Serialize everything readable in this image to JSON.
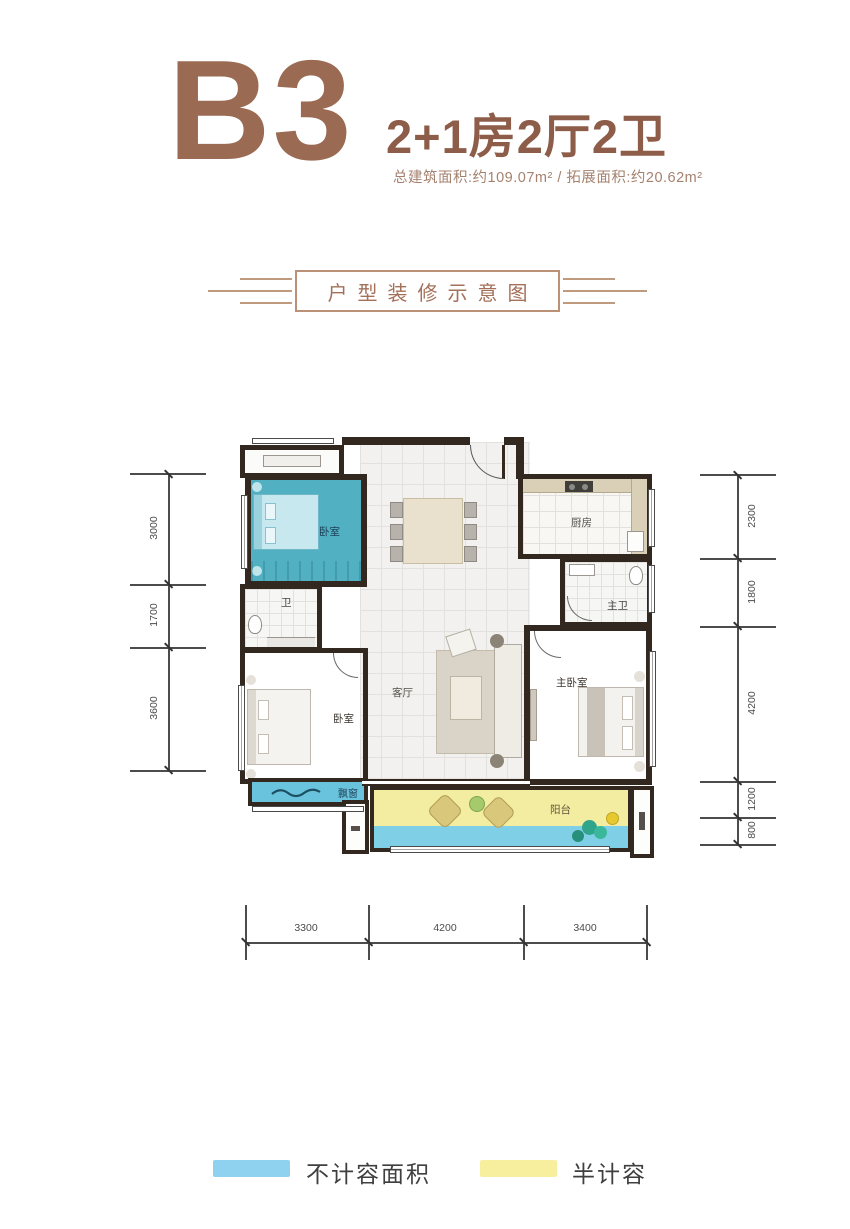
{
  "header": {
    "unit": "B3",
    "layout": "2+1房2厅2卫",
    "area_info": "总建筑面积:约109.07m² / 拓展面积:约20.62m²"
  },
  "banner": {
    "title": "户型装修示意图"
  },
  "rooms": {
    "bedroom_top": "卧室",
    "kitchen": "厨房",
    "master_bath": "主卫",
    "bath": "卫",
    "living": "客厅",
    "bedroom_left": "卧室",
    "master_bedroom": "主卧室",
    "bay_window": "飘窗",
    "balcony": "阳台"
  },
  "dimensions": {
    "left": [
      "3000",
      "1700",
      "3600"
    ],
    "right": [
      "2300",
      "1800",
      "4200",
      "1200",
      "800"
    ],
    "bottom": [
      "3300",
      "4200",
      "3400"
    ]
  },
  "legend": [
    {
      "label": "不计容面积",
      "color": "#8fd2f0"
    },
    {
      "label": "半计容",
      "color": "#f7ef9e"
    }
  ],
  "colors": {
    "accent_brown": "#9a6a53",
    "wall": "#32281f",
    "teal_room": "#52b0c3",
    "bay_blue": "#69c3dc",
    "balcony_yellow": "#f3eda1",
    "water_blue": "#7fd0e6"
  }
}
